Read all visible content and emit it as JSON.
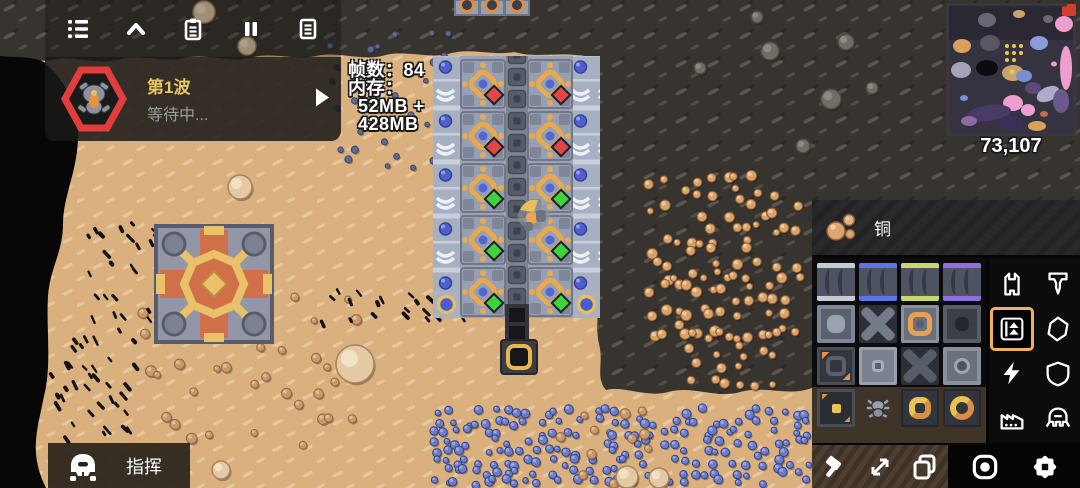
{
  "hud": {
    "toolbar": {
      "icons": [
        "menu-icon",
        "chevron-up-icon",
        "schematics-icon",
        "pause-icon",
        "database-icon"
      ]
    },
    "wave": {
      "label": "第1波",
      "status": "等待中...",
      "enemy_icon": "crawler-enemy-icon",
      "play_icon": "play-icon"
    },
    "perf": {
      "fps_line": "帧数：84",
      "memory_label": "内存：",
      "memory_line1": "52MB +",
      "memory_line2": "428MB"
    },
    "minimap": {
      "coordinates": "73,107"
    },
    "command_button": {
      "label": "指挥",
      "icon": "mech-unit-icon"
    }
  },
  "right_panel": {
    "item_bar": {
      "item": "铜",
      "icon": "copper-ore-icon"
    },
    "block_grid": {
      "rows": 4,
      "cols": 4,
      "slots": [
        "conveyor",
        "titanium-conveyor",
        "plastanium-conveyor",
        "phase-conveyor",
        "router",
        "junction",
        "sorter",
        "dark-router",
        "overflow-gate",
        "distributor",
        "inverted-junction",
        "round-router",
        "charged-block",
        "spider-unit-block",
        "square-ring-block",
        "circle-ring-block"
      ]
    },
    "categories": [
      {
        "name": "turret",
        "selected": false
      },
      {
        "name": "drill",
        "selected": false
      },
      {
        "name": "distribution",
        "selected": true
      },
      {
        "name": "liquid",
        "selected": false
      },
      {
        "name": "power",
        "selected": false
      },
      {
        "name": "defense",
        "selected": false
      },
      {
        "name": "crafting",
        "selected": false
      },
      {
        "name": "units",
        "selected": false
      }
    ],
    "tools": [
      "break-tool",
      "resize-tool",
      "copy-tool",
      "target-tool",
      "settings-tool"
    ]
  },
  "colors": {
    "selection_accent": "#f1b156",
    "wave_label": "#e8c565",
    "danger": "#e23c3c",
    "copper": "#d9a06a",
    "status_ok": "#3ed43e",
    "status_bad": "#e04848",
    "sand": "#d9b07e",
    "rock": "#37332e"
  }
}
